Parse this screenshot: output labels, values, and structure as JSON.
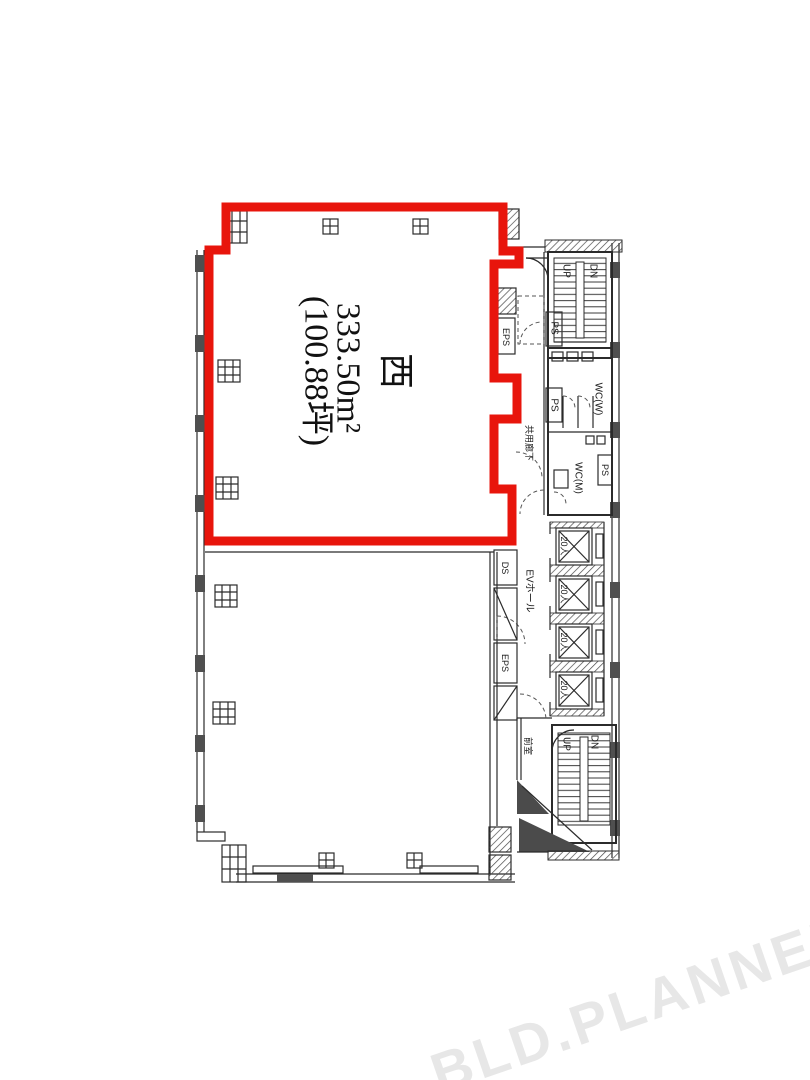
{
  "document": {
    "type": "floor-plan"
  },
  "unit": {
    "name": "西",
    "area_m2": "333.50m²",
    "area_tsubo": "(100.88坪)"
  },
  "core": {
    "stair_up": "UP",
    "stair_down": "DN",
    "wc_women": "WC(W)",
    "wc_men": "WC(M)",
    "corridor": "共用廊下",
    "ev_hall": "EVホール",
    "ev_capacity": "20人",
    "ev_count": 4,
    "anteroom": "前室",
    "shaft_ps": "PS",
    "shaft_eps": "EPS",
    "shaft_ds": "DS"
  },
  "watermark": "BLD.PLANNER",
  "colors": {
    "unit_outline": "#e8150c",
    "drawing_line": "#2b2b2b",
    "watermark": "#e7e7e7"
  }
}
